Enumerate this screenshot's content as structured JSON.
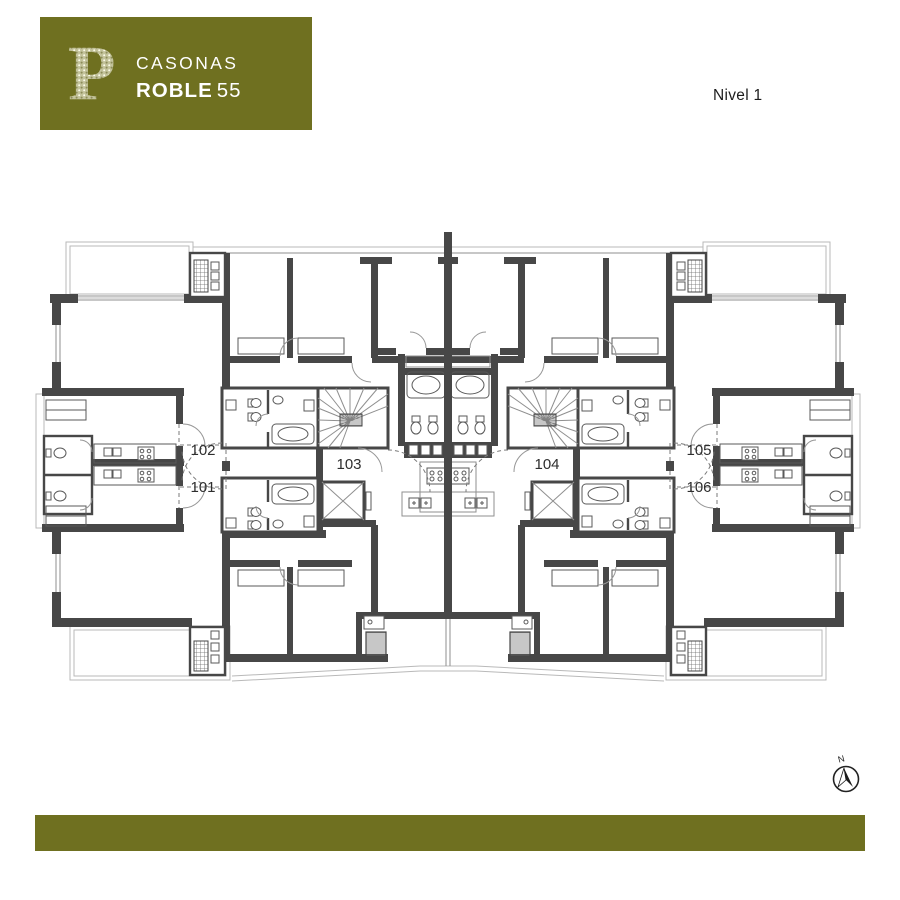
{
  "brand": {
    "monogram": "P",
    "line1": "CASONAS",
    "line2_bold": "ROBLE",
    "line2_light": "55"
  },
  "plan": {
    "level_label": "Nivel 1",
    "units": [
      {
        "label": "101"
      },
      {
        "label": "102"
      },
      {
        "label": "103"
      },
      {
        "label": "104"
      },
      {
        "label": "105"
      },
      {
        "label": "106"
      }
    ],
    "compass": {
      "label": "N"
    }
  },
  "colors": {
    "brand_olive": "#6f7020",
    "wall": "#474747",
    "label_text": "#2e2e2e",
    "line_light": "#b9b9b9",
    "line_mid": "#8f8f8f"
  }
}
